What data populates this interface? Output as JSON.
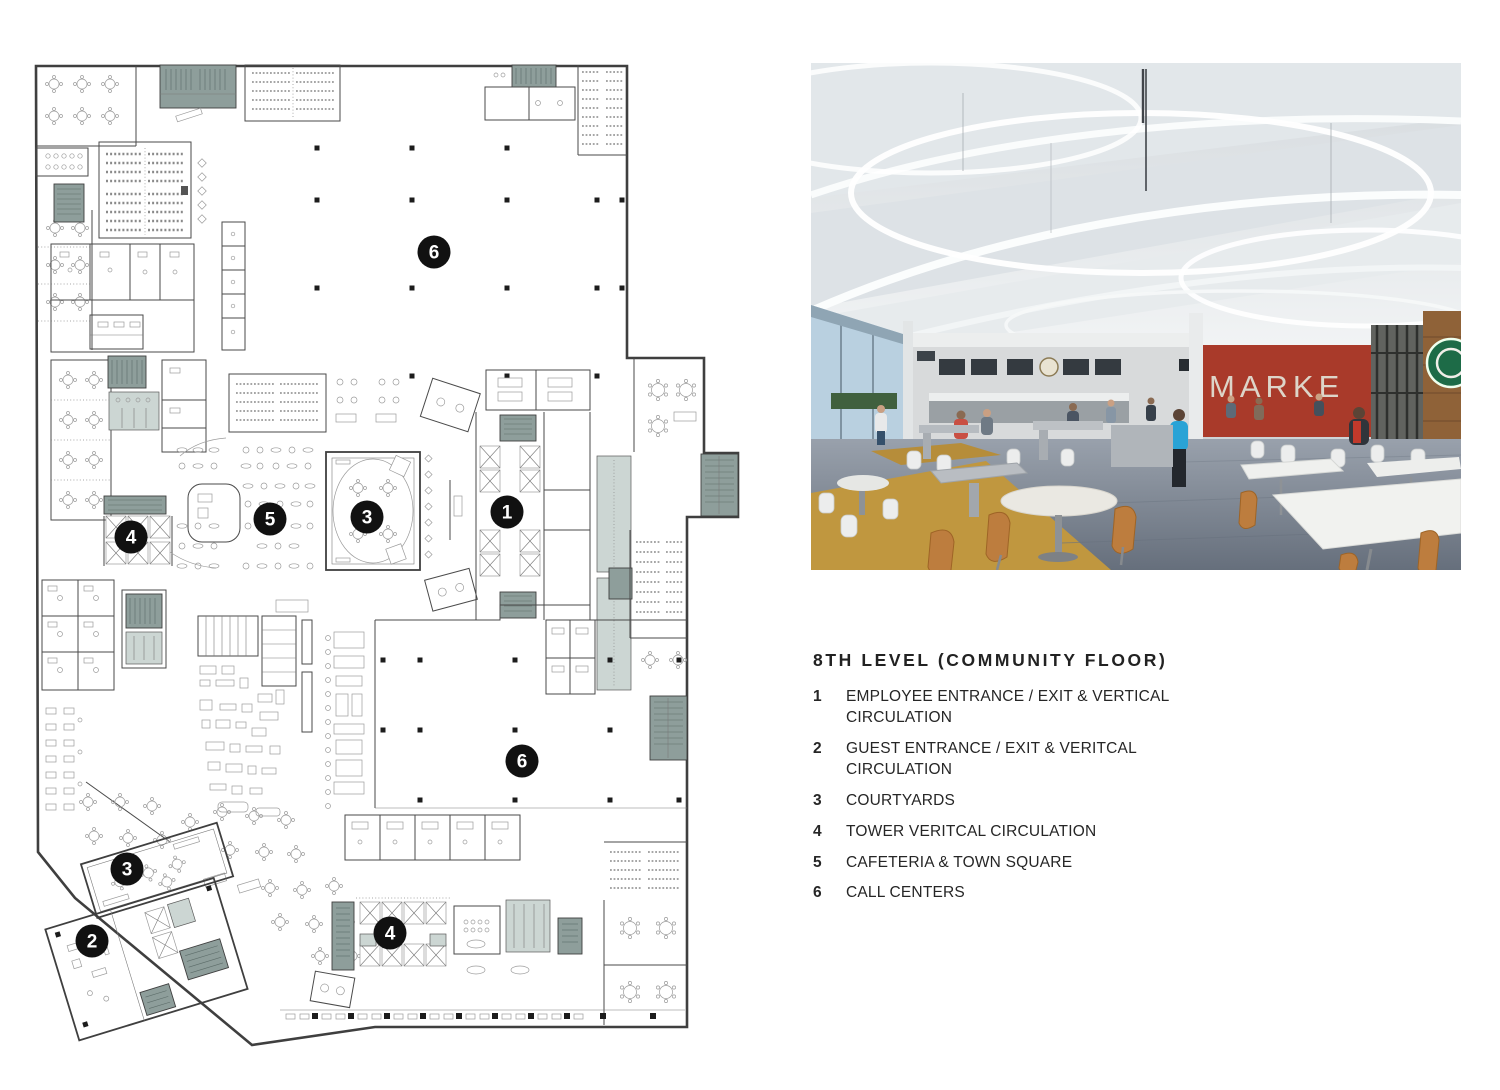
{
  "legend": {
    "title": "8TH LEVEL (COMMUNITY FLOOR)",
    "items": [
      {
        "num": "1",
        "label": "EMPLOYEE ENTRANCE / EXIT & VERTICAL CIRCULATION"
      },
      {
        "num": "2",
        "label": "GUEST ENTRANCE / EXIT & VERITCAL CIRCULATION"
      },
      {
        "num": "3",
        "label": "COURTYARDS"
      },
      {
        "num": "4",
        "label": "TOWER VERITCAL CIRCULATION"
      },
      {
        "num": "5",
        "label": "CAFETERIA & TOWN SQUARE"
      },
      {
        "num": "6",
        "label": "CALL CENTERS"
      }
    ]
  },
  "floorplan": {
    "markers": [
      {
        "num": "6",
        "x": 404,
        "y": 192
      },
      {
        "num": "1",
        "x": 477,
        "y": 452
      },
      {
        "num": "5",
        "x": 240,
        "y": 459
      },
      {
        "num": "3",
        "x": 337,
        "y": 457
      },
      {
        "num": "4",
        "x": 101,
        "y": 477
      },
      {
        "num": "6",
        "x": 492,
        "y": 701
      },
      {
        "num": "3",
        "x": 97,
        "y": 809
      },
      {
        "num": "2",
        "x": 62,
        "y": 881
      },
      {
        "num": "4",
        "x": 360,
        "y": 873
      }
    ],
    "colors": {
      "wall": "#4a4a4a",
      "core_dark": "#8e9e9b",
      "core_light": "#ccd6d3",
      "marker": "#111111"
    }
  },
  "photo": {
    "sign_text": "MARKE",
    "colors": {
      "red_wall": "#a93a2a",
      "carpet_gray": "#848e9b",
      "carpet_ochre": "#c0973f",
      "wood_chair": "#bd7d3e",
      "logo_green": "#1d6b47",
      "ceiling": "#e8ecee"
    }
  }
}
